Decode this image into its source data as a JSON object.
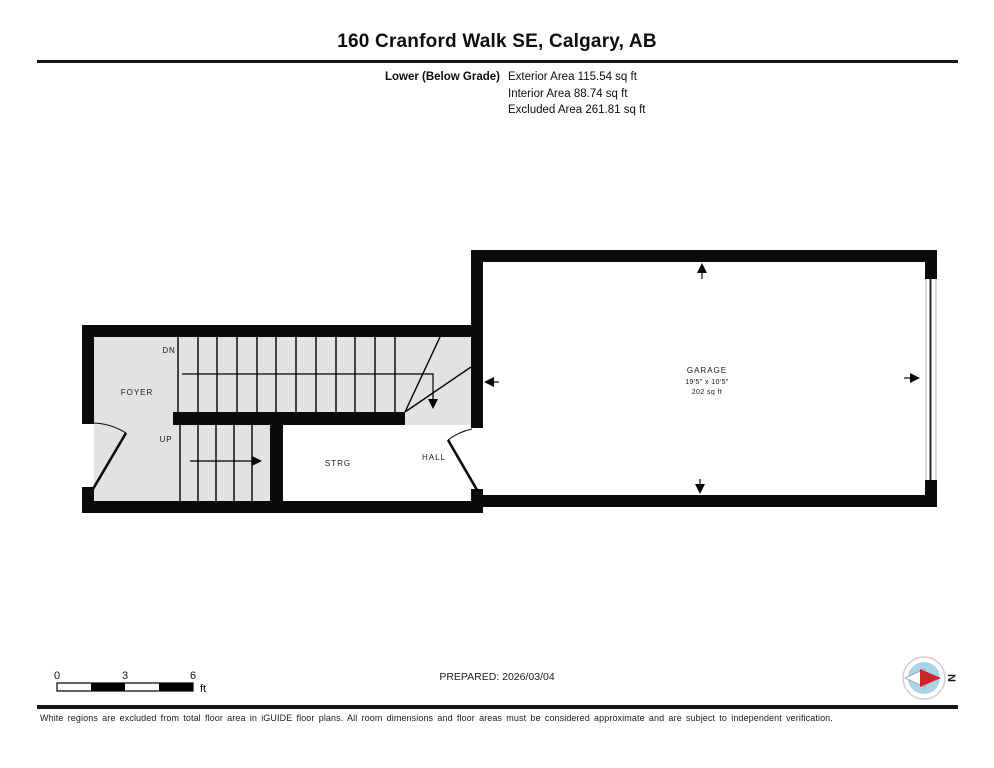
{
  "header": {
    "title": "160 Cranford Walk SE, Calgary, AB",
    "floor_label": "Lower (Below Grade)",
    "areas": [
      "Exterior Area 115.54 sq ft",
      "Interior Area 88.74 sq ft",
      "Excluded Area 261.81 sq ft"
    ]
  },
  "plan": {
    "rooms": [
      {
        "name": "FOYER"
      },
      {
        "name": "STRG"
      },
      {
        "name": "HALL"
      },
      {
        "name": "GARAGE",
        "dimensions": "19'5\" x 10'5\"",
        "area": "202 sq ft"
      }
    ],
    "stairs": [
      {
        "label": "DN"
      },
      {
        "label": "UP"
      }
    ],
    "colors": {
      "wall": "#000000",
      "excluded_fill": "#e2e2e2",
      "included_fill": "#ffffff"
    }
  },
  "footer": {
    "scale": {
      "ticks": [
        "0",
        "3",
        "6"
      ],
      "unit": "ft"
    },
    "prepared": "PREPARED: 2026/03/04",
    "compass": {
      "label": "N",
      "needle_color": "#c9252c",
      "disc_color": "#a9d3e9"
    },
    "disclaimer": "White regions are excluded from total floor area in iGUIDE floor plans. All room dimensions and floor areas must be considered approximate and are subject to independent verification."
  }
}
